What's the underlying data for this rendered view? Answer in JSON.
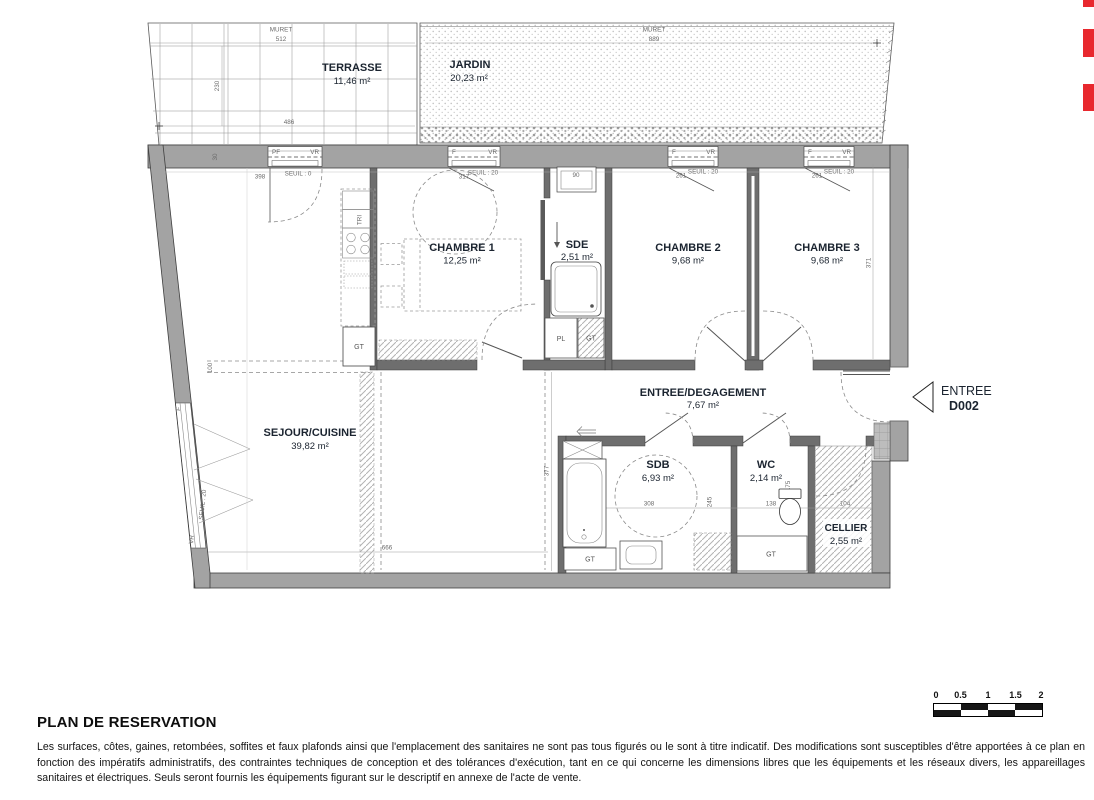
{
  "plan": {
    "terrasse": {
      "name": "TERRASSE",
      "area": "11,46 m²",
      "muret_label": "MURET",
      "muret_dim": "512",
      "depth_dim": "230",
      "width_dim": "486"
    },
    "jardin": {
      "name": "JARDIN",
      "area": "20,23 m²",
      "muret_label": "MURET",
      "muret_dim": "889"
    },
    "sejour": {
      "name": "SEJOUR/CUISINE",
      "area": "39,82 m²",
      "width_dim": "666",
      "height_dim": "377",
      "left_dim": "100"
    },
    "chambre1": {
      "name": "CHAMBRE 1",
      "area": "12,25 m²"
    },
    "chambre2": {
      "name": "CHAMBRE 2",
      "area": "9,68 m²",
      "window_dim": "261",
      "seuil": "SEUIL : 20"
    },
    "chambre3": {
      "name": "CHAMBRE 3",
      "area": "9,68 m²",
      "window_dim": "261",
      "seuil": "SEUIL : 20",
      "height_dim": "371"
    },
    "sde": {
      "name": "SDE",
      "area": "2,51 m²",
      "basin_dim": "90"
    },
    "sdb": {
      "name": "SDB",
      "area": "6,93 m²",
      "width_dim": "308",
      "height_dim": "245"
    },
    "wc": {
      "name": "WC",
      "area": "2,14 m²",
      "width_dim": "138",
      "height_dim": "175"
    },
    "cellier": {
      "name": "CELLIER",
      "area": "2,55 m²",
      "width_dim": "104"
    },
    "entree_degagement": {
      "name": "ENTREE/DEGAGEMENT",
      "area": "7,67 m²"
    },
    "entrance": {
      "label": "ENTREE",
      "door_code": "D002"
    },
    "window1": {
      "left_label": "PF",
      "right_label": "VR",
      "seuil": "SEUIL : 0",
      "dim": "398"
    },
    "window2": {
      "left_label": "F",
      "right_label": "VR",
      "seuil": "SEUIL : 20",
      "dim": "317"
    },
    "window3": {
      "left_label": "F",
      "right_label": "VR"
    },
    "window4": {
      "left_label": "F",
      "right_label": "VR"
    },
    "bay_window": {
      "top_label": "F",
      "bottom_label": "VR",
      "seuil": "SEUIL : 20"
    },
    "labels": {
      "gt": "GT",
      "pl": "PL",
      "tri": "TRI",
      "wall_dim": "30"
    }
  },
  "footer": {
    "title": "PLAN DE RESERVATION",
    "disclaimer": "Les surfaces, côtes, gaines, retombées, soffites et faux plafonds ainsi que l'emplacement des sanitaires ne sont pas tous figurés ou le sont à titre indicatif. Des modifications sont susceptibles d'être apportées à ce plan en fonction des impératifs administratifs, des contraintes techniques de conception et des tolérances d'exécution, tant en ce qui concerne les dimensions libres que les équipements et les réseaux divers, les appareillages sanitaires et électriques. Seuls seront fournis les équipements figurant sur le descriptif en annexe de l'acte de vente.",
    "scale": {
      "labels": [
        "0",
        "0.5",
        "1",
        "1.5",
        "2"
      ]
    }
  },
  "colors": {
    "exterior_wall": "#a3a3a3",
    "partition_wall": "#6e6e6e",
    "red_mark": "#e8282e"
  }
}
